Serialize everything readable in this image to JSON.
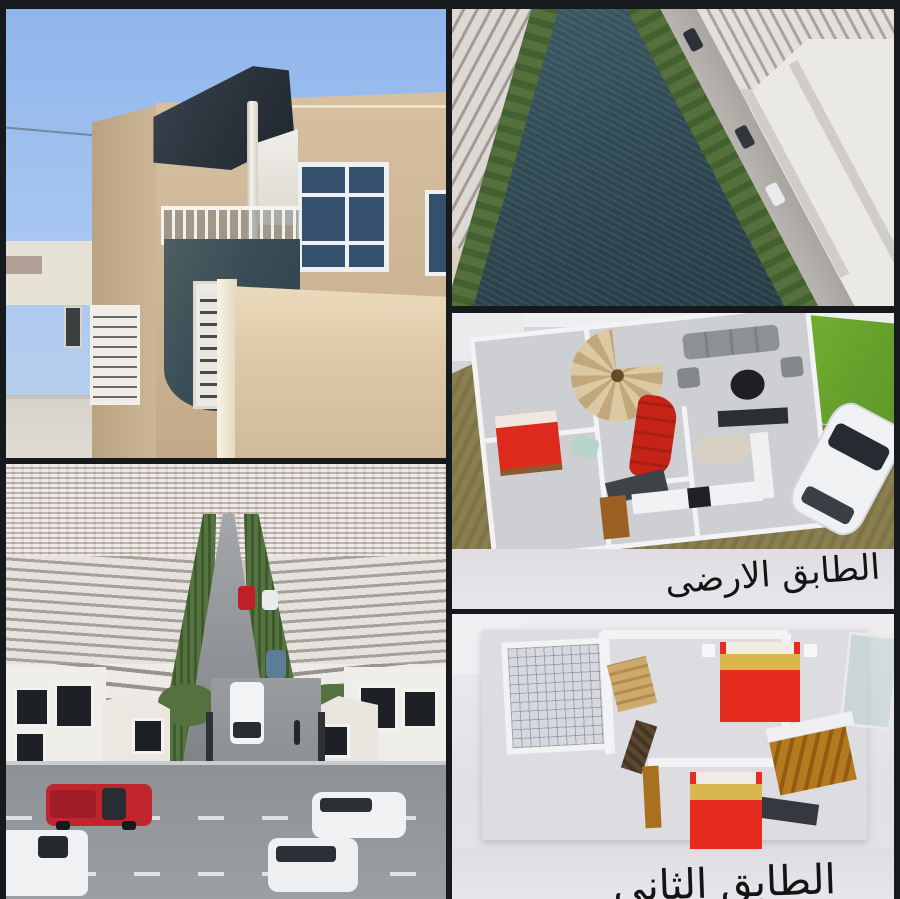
{
  "collage_type": "real-estate-project-collage",
  "panels": {
    "house_photo": {
      "name": "villa-exterior-photo"
    },
    "canal_render": {
      "name": "canal-aerial-render"
    },
    "street_render": {
      "name": "street-aerial-render"
    },
    "ground_floor_plan": {
      "name": "ground-floor-3d-plan",
      "caption": "الطابق الارضى"
    },
    "second_floor_plan": {
      "name": "second-floor-3d-plan",
      "caption": "الطابق الثانى"
    }
  },
  "colors": {
    "frame": "#171a1c",
    "sky": "#9fc0ee",
    "house_beige": "#cdb695",
    "roof_dark": "#2c343e",
    "water_teal": "#2f4a52",
    "tree_green": "#4c6836",
    "lawn_green": "#6aa92e",
    "bed_red": "#df2b1d",
    "yard_khaki": "#857a4b",
    "plan_gray": "#d5d5d9",
    "caption_text": "#141414"
  }
}
